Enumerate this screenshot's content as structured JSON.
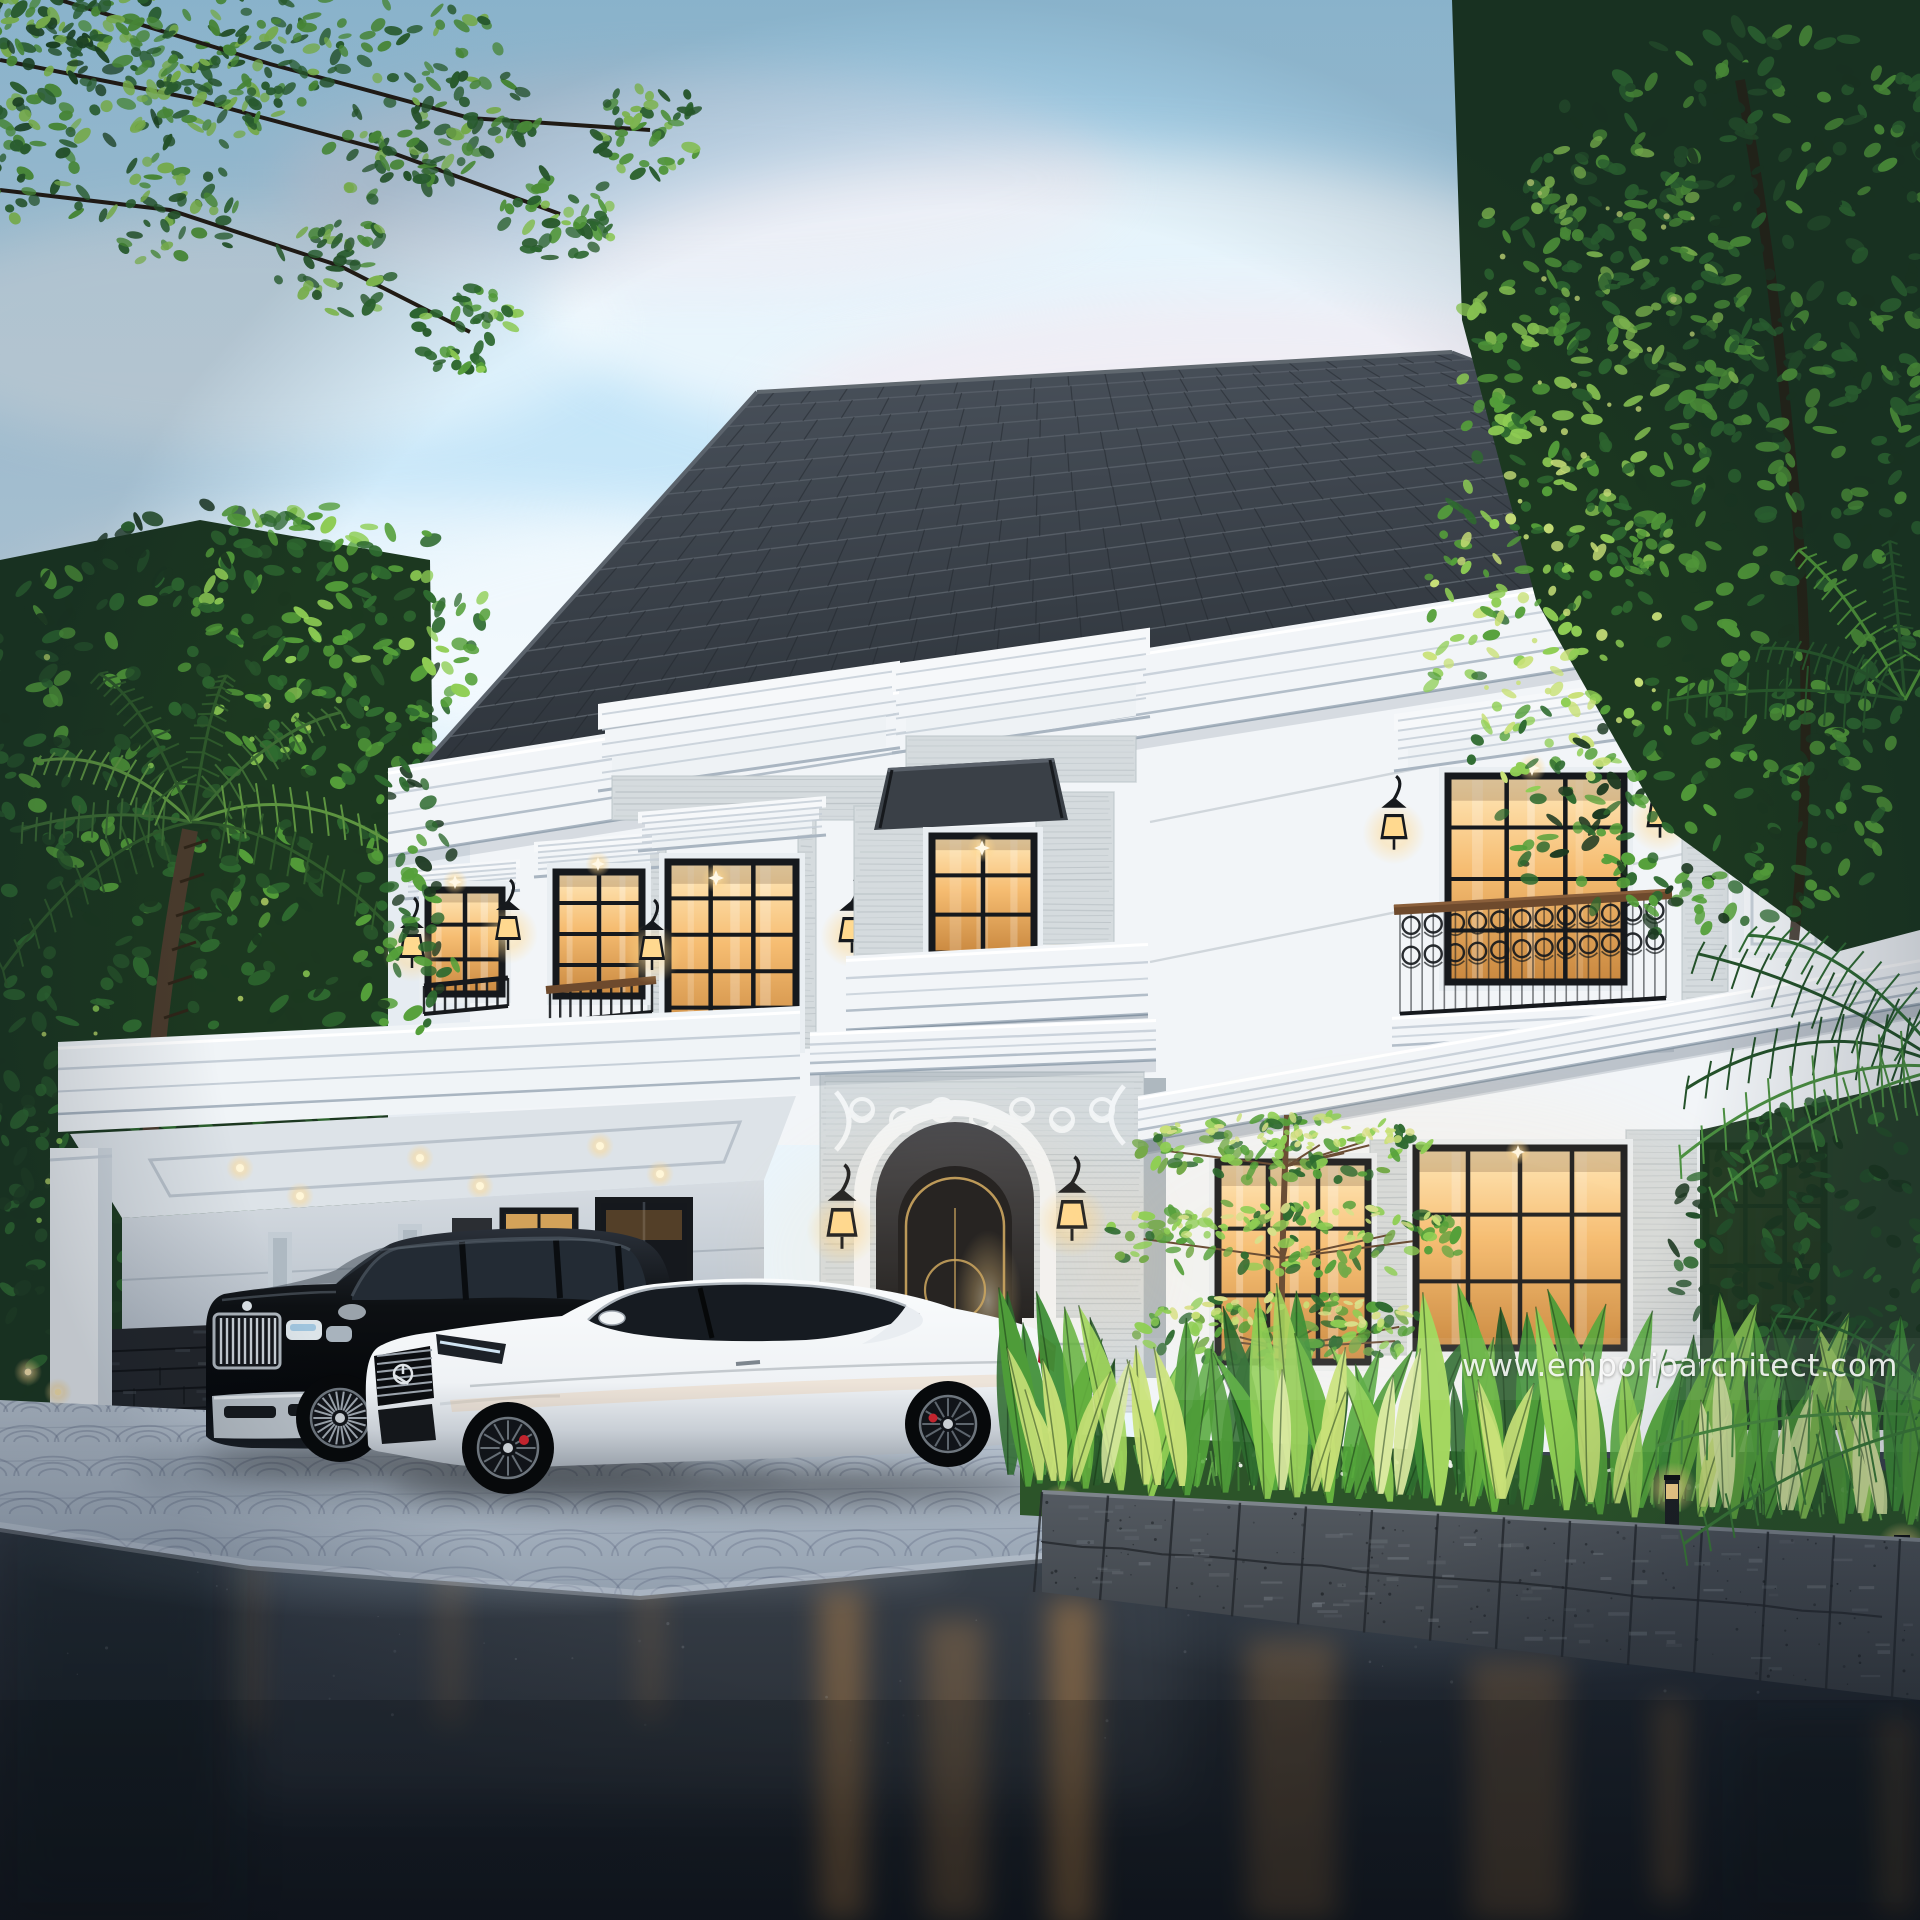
{
  "scene": {
    "title": "Two-story classic luxury villa exterior 3D render at dusk",
    "watermark": "www.emporioarchitect.com",
    "objects": [
      "sky",
      "clouds",
      "overhanging-tree",
      "background-trees",
      "palm-trees",
      "dark-hip-roof",
      "crown-cornice",
      "white-classic-facade",
      "travertine-entrance-tower",
      "arched-entry-door",
      "wall-lanterns",
      "juliet-balconies",
      "ornate-iron-balcony",
      "carport",
      "black-suv",
      "white-coupe",
      "tropical-garden",
      "tiered-ornamental-tree",
      "stone-planter-wall",
      "bollard-lights",
      "fan-paver-driveway",
      "wet-road-reflection",
      "watermark"
    ]
  },
  "palette": {
    "sky_top": "#a9daf4",
    "sky_mid": "#cfeafa",
    "sky_low": "#eaf5fc",
    "cloud": "#ffffff",
    "cloud_pink": "#f6e6ee",
    "roof_top": "#4b535d",
    "roof_bottom": "#2d333a",
    "roof_joint": "#7b838c",
    "roof_tick": "#22272d",
    "facade": "#f2f5f8",
    "facade_shade": "#dde4ec",
    "cornice_line": "#c6cfd8",
    "cornice_deep": "#a9b5c1",
    "travertine": "#d5dbde",
    "travertine_line": "#8f9aa0",
    "frame_black": "#16191d",
    "glass_hi": "#ffe9bb",
    "glass_warm": "#f6bd72",
    "glass_deep": "#c9883f",
    "lantern_glow": "#ffd78a",
    "wood_rail": "#6e4a2d",
    "leaf_dark": "#1c3820",
    "leaf_mid": "#2f6b30",
    "leaf_bright": "#55a03a",
    "leaf_light": "#8fce54",
    "leaf_backlit": "#c9e178",
    "palm_trunk": "#4a3b2c",
    "stone_wall": "#545a61",
    "stone_dark": "#33383e",
    "ledgestone": "#23262b",
    "paver": "#bdc8d4",
    "paver_deep": "#93a0af",
    "paver_joint": "#55617a",
    "road_top": "#3b444f",
    "road_bottom": "#14181e",
    "car_black": "#0d1013",
    "car_white": "#eff2f5",
    "chrome": "#ccd3d9",
    "brake_red": "#c2242e",
    "tail_red": "#a01825",
    "door_black": "#141519",
    "door_gold": "#c9a35c",
    "glow_warm": "#ffcf8a"
  }
}
